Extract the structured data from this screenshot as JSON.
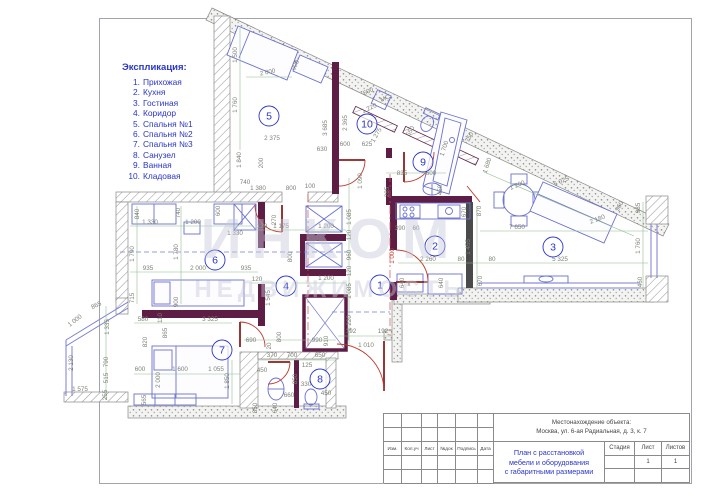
{
  "legend": {
    "title": "Экспликация:",
    "items": [
      {
        "n": "1.",
        "label": "Прихожая"
      },
      {
        "n": "2.",
        "label": "Кухня"
      },
      {
        "n": "3.",
        "label": "Гостиная"
      },
      {
        "n": "4.",
        "label": "Коридор"
      },
      {
        "n": "5.",
        "label": "Спальня №1"
      },
      {
        "n": "6.",
        "label": "Спальня №2"
      },
      {
        "n": "7.",
        "label": "Спальня №3"
      },
      {
        "n": "8.",
        "label": "Санузел"
      },
      {
        "n": "9.",
        "label": "Ванная"
      },
      {
        "n": "10.",
        "label": "Кладовая"
      }
    ]
  },
  "watermark": {
    "line1": "ИНКОМ",
    "line2": "НЕДВИЖИМОСТЬ"
  },
  "title_block": {
    "location_label": "Местонахождение объекта:",
    "location_value": "Москва, ул. 6-ая Радиальная, д. 3, к. 7",
    "doc_title_line1": "План с расстановкой",
    "doc_title_line2": "мебели и оборудования",
    "doc_title_line3": "с габаритными размерами",
    "col_stage": "Стадия",
    "col_sheet": "Лист",
    "col_sheets": "Листов",
    "stage_value": "",
    "sheet_value": "1",
    "sheets_value": "1",
    "row_labels": [
      "Изм.",
      "Кол.уч",
      "Лист",
      "№док",
      "Подпись",
      "Дата"
    ]
  },
  "colors": {
    "accent_blue": "#2a35c8",
    "wall_purple": "#5e1d45",
    "door_red": "#c0392b",
    "furniture_blue": "#6a6fd0",
    "dim_green": "#7cae7c",
    "dim_text": "#7d8276",
    "watermark": "#c6cada"
  },
  "rooms": [
    {
      "n": "1",
      "x": 380,
      "y": 285
    },
    {
      "n": "2",
      "x": 435,
      "y": 246
    },
    {
      "n": "3",
      "x": 553,
      "y": 247
    },
    {
      "n": "4",
      "x": 286,
      "y": 286
    },
    {
      "n": "5",
      "x": 269,
      "y": 116
    },
    {
      "n": "6",
      "x": 215,
      "y": 260
    },
    {
      "n": "7",
      "x": 222,
      "y": 350
    },
    {
      "n": "8",
      "x": 320,
      "y": 379
    },
    {
      "n": "9",
      "x": 423,
      "y": 162
    },
    {
      "n": "10",
      "x": 367,
      "y": 124
    }
  ],
  "plan_labels": [
    [
      "МС",
      386,
      100,
      -25
    ],
    [
      "x",
      409,
      286,
      0
    ]
  ],
  "dimensions": [
    [
      "1 500",
      237,
      55,
      -90
    ],
    [
      "2 000",
      268,
      74,
      -12
    ],
    [
      "900",
      297,
      66,
      -65
    ],
    [
      "1 760",
      237,
      105,
      -90
    ],
    [
      "1 840",
      241,
      160,
      -90
    ],
    [
      "200",
      263,
      163,
      -90
    ],
    [
      "2 375",
      272,
      140,
      0
    ],
    [
      "3 685",
      327,
      128,
      -90
    ],
    [
      "630",
      322,
      151,
      0
    ],
    [
      "740",
      245,
      184,
      0
    ],
    [
      "1 380",
      258,
      190,
      0
    ],
    [
      "800",
      291,
      190,
      0
    ],
    [
      "100",
      310,
      188,
      0
    ],
    [
      "600",
      369,
      93,
      -25
    ],
    [
      "1 220",
      370,
      110,
      -25
    ],
    [
      "2 365",
      347,
      123,
      -90
    ],
    [
      "1 275",
      378,
      136,
      -60
    ],
    [
      "550",
      412,
      132,
      -60
    ],
    [
      "600",
      345,
      146,
      0
    ],
    [
      "625",
      367,
      146,
      0
    ],
    [
      "1 700",
      446,
      149,
      -72
    ],
    [
      "750",
      471,
      138,
      -62
    ],
    [
      "835",
      402,
      175,
      0
    ],
    [
      "600",
      431,
      175,
      0
    ],
    [
      "450",
      442,
      190,
      -90
    ],
    [
      "285",
      389,
      192,
      -90
    ],
    [
      "1 680",
      489,
      166,
      -72
    ],
    [
      "1 200",
      518,
      187,
      -22
    ],
    [
      "5 025",
      562,
      183,
      -23
    ],
    [
      "2 180",
      598,
      221,
      -21
    ],
    [
      "960",
      621,
      207,
      -62
    ],
    [
      "985",
      640,
      208,
      -90
    ],
    [
      "870",
      481,
      211,
      -90
    ],
    [
      "7 650",
      517,
      229,
      0
    ],
    [
      "1 455",
      470,
      247,
      -90
    ],
    [
      "1 760",
      640,
      246,
      -90
    ],
    [
      "5 325",
      560,
      261,
      0
    ],
    [
      "80",
      492,
      261,
      0
    ],
    [
      "670",
      482,
      281,
      -90
    ],
    [
      "460",
      642,
      282,
      -90
    ],
    [
      "2 260",
      428,
      261,
      0
    ],
    [
      "80",
      461,
      261,
      0
    ],
    [
      "640",
      443,
      283,
      -90
    ],
    [
      "640",
      404,
      283,
      -90
    ],
    [
      "670",
      466,
      212,
      -90
    ],
    [
      "1 000",
      394,
      256,
      -90,
      "red"
    ],
    [
      "1 090",
      362,
      181,
      -90
    ],
    [
      "1 085",
      351,
      217,
      -90
    ],
    [
      "120",
      351,
      235,
      -90
    ],
    [
      "960",
      351,
      255,
      -90
    ],
    [
      "120",
      351,
      271,
      -90
    ],
    [
      "1 085",
      351,
      291,
      -90
    ],
    [
      "1 220",
      351,
      323,
      -90
    ],
    [
      "390",
      400,
      230,
      0
    ],
    [
      "60",
      416,
      230,
      0
    ],
    [
      "192",
      351,
      333,
      0
    ],
    [
      "192",
      383,
      333,
      0
    ],
    [
      "1 010",
      366,
      347,
      0
    ],
    [
      "130",
      262,
      228,
      0
    ],
    [
      "1 175",
      281,
      228,
      0
    ],
    [
      "270",
      276,
      220,
      -90
    ],
    [
      "800",
      292,
      257,
      -90
    ],
    [
      "1 200",
      326,
      228,
      0
    ],
    [
      "1 200",
      326,
      280,
      0
    ],
    [
      "1 545",
      270,
      298,
      -90
    ],
    [
      "120",
      257,
      281,
      0
    ],
    [
      "840",
      139,
      214,
      -90
    ],
    [
      "740",
      180,
      213,
      -90
    ],
    [
      "600",
      220,
      211,
      -90
    ],
    [
      "1 330",
      150,
      224,
      0
    ],
    [
      "1 200",
      193,
      224,
      0
    ],
    [
      "1 330",
      235,
      235,
      0
    ],
    [
      "1 790",
      134,
      254,
      -90
    ],
    [
      "1 780",
      178,
      252,
      -90
    ],
    [
      "935",
      148,
      270,
      0
    ],
    [
      "2 000",
      198,
      270,
      0
    ],
    [
      "935",
      246,
      270,
      0
    ],
    [
      "715",
      134,
      298,
      -90
    ],
    [
      "900",
      178,
      302,
      -90
    ],
    [
      "580",
      143,
      321,
      0
    ],
    [
      "110",
      162,
      318,
      -90
    ],
    [
      "3 325",
      210,
      321,
      0
    ],
    [
      "865",
      167,
      333,
      -90
    ],
    [
      "865",
      97,
      307,
      -25
    ],
    [
      "1 000",
      76,
      322,
      -38
    ],
    [
      "1 335",
      109,
      327,
      -90
    ],
    [
      "820",
      147,
      342,
      -90
    ],
    [
      "790",
      108,
      362,
      -90
    ],
    [
      "515",
      108,
      378,
      -90
    ],
    [
      "255",
      107,
      395,
      -90
    ],
    [
      "2 130",
      73,
      363,
      -90
    ],
    [
      "1 575",
      80,
      391,
      0
    ],
    [
      "600",
      140,
      371,
      0
    ],
    [
      "2 000",
      160,
      380,
      -90
    ],
    [
      "1 600",
      180,
      371,
      0
    ],
    [
      "1 055",
      216,
      371,
      0
    ],
    [
      "1 850",
      229,
      381,
      -90
    ],
    [
      "565",
      146,
      400,
      -90
    ],
    [
      "690",
      251,
      342,
      0
    ],
    [
      "20",
      271,
      346,
      -90
    ],
    [
      "800",
      281,
      337,
      -90
    ],
    [
      "990",
      317,
      342,
      0
    ],
    [
      "910",
      328,
      341,
      -90
    ],
    [
      "370",
      272,
      357,
      0
    ],
    [
      "700",
      292,
      357,
      0
    ],
    [
      "650",
      320,
      357,
      0
    ],
    [
      "125",
      307,
      367,
      0
    ],
    [
      "450",
      262,
      372,
      0
    ],
    [
      "850",
      297,
      379,
      -90
    ],
    [
      "330",
      306,
      386,
      0
    ],
    [
      "660",
      289,
      397,
      0
    ],
    [
      "450",
      326,
      395,
      0
    ],
    [
      "850",
      257,
      408,
      -90
    ],
    [
      "640",
      277,
      408,
      -90
    ]
  ]
}
